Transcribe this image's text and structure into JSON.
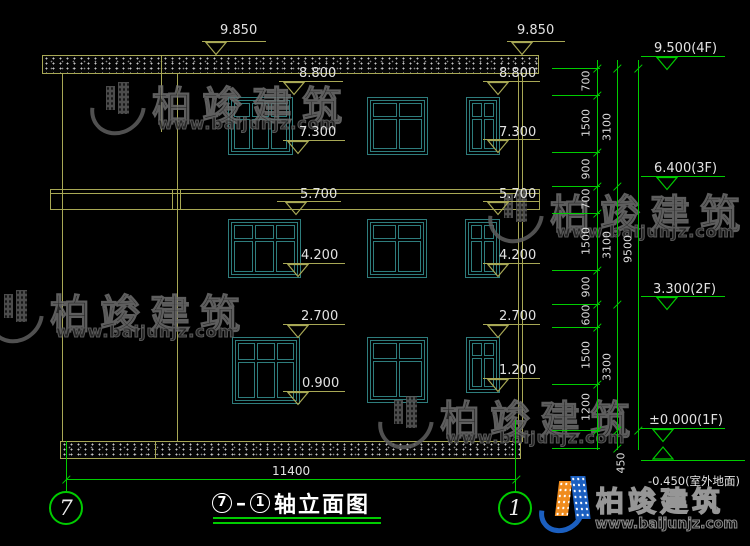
{
  "title_block": {
    "title_circle_left": "7",
    "title_dash": "–",
    "title_circle_right": "1",
    "title_text": "轴立面图",
    "axis_bubble_left": "7",
    "axis_bubble_right": "1",
    "bottom_dimension": "11400"
  },
  "elevation_markers_left": [
    "9.850",
    "9.850",
    "8.800",
    "8.800",
    "7.300",
    "7.300",
    "5.700",
    "5.700",
    "4.200",
    "4.200",
    "2.700",
    "2.700",
    "0.900",
    "1.200"
  ],
  "floor_levels_right": [
    "9.500(4F)",
    "6.400(3F)",
    "3.300(2F)",
    "±0.000(1F)",
    "-0.450(室外地面)"
  ],
  "dimension_chain": {
    "segments_inner": [
      "700",
      "1500",
      "900",
      "700",
      "1500",
      "900",
      "600",
      "1500",
      "1200"
    ],
    "segments_middle": [
      "3100",
      "3100",
      "3300"
    ],
    "segment_total": [
      "9500"
    ],
    "segment_ground": "450"
  },
  "watermark": {
    "brand": "柏竣建筑",
    "url": "www.baijunjz.com"
  },
  "brand_footer": {
    "brand": "柏竣建筑",
    "url": "www.baijunjz.com"
  },
  "colors": {
    "line_yellow": "#a8a855",
    "line_green": "#00cc00",
    "window_teal": "#2e7d7d",
    "dim_text": "#e2e2e2"
  }
}
